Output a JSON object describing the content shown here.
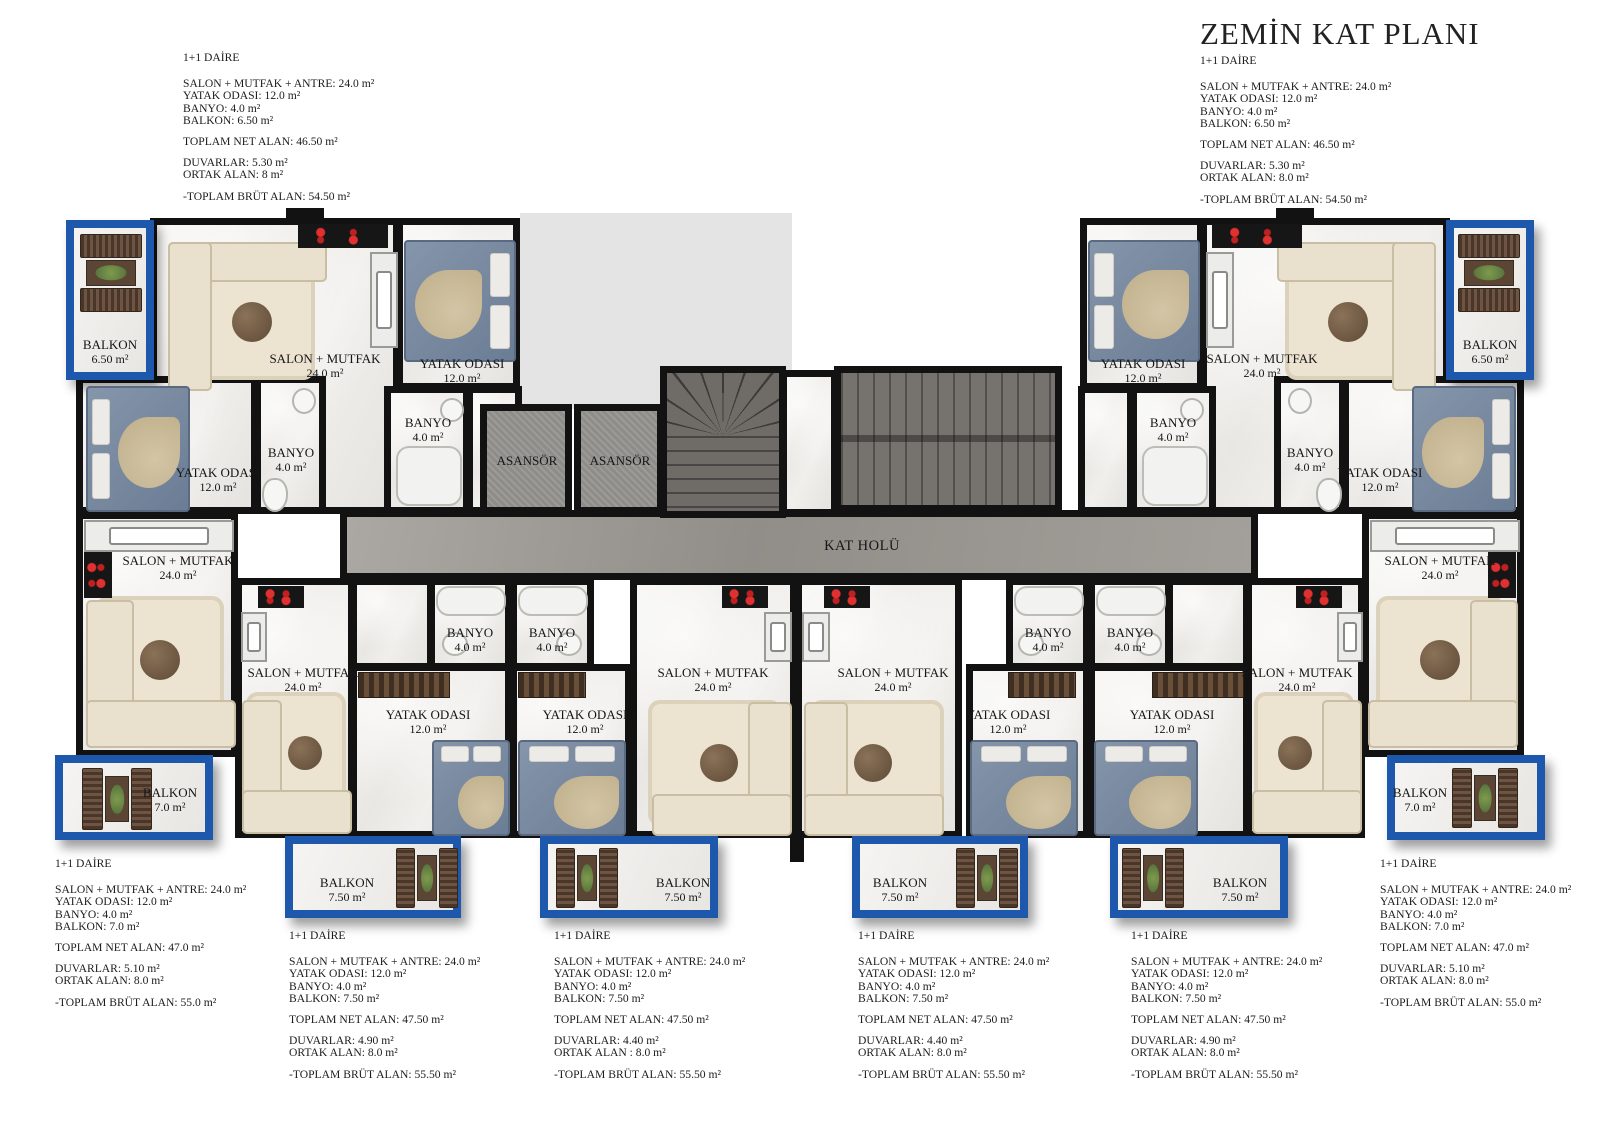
{
  "title": "ZEMİN KAT PLANI",
  "apartment_specs": [
    {
      "heading": "1+1 DAİRE",
      "salon": "SALON + MUTFAK + ANTRE: 24.0 m²",
      "bedroom": "YATAK ODASI: 12.0 m²",
      "bath": "BANYO: 4.0 m²",
      "balcony": "BALKON: 6.50 m²",
      "net": "TOPLAM NET ALAN: 46.50 m²",
      "walls": "DUVARLAR: 5.30 m²",
      "common": "ORTAK ALAN: 8 m²",
      "gross": "-TOPLAM BRÜT ALAN:  54.50 m²"
    },
    {
      "heading": "1+1 DAİRE",
      "salon": "SALON + MUTFAK + ANTRE: 24.0 m²",
      "bedroom": "YATAK ODASI: 12.0 m²",
      "bath": "BANYO: 4.0 m²",
      "balcony": "BALKON: 6.50 m²",
      "net": "TOPLAM NET ALAN: 46.50 m²",
      "walls": "DUVARLAR: 5.30 m²",
      "common": "ORTAK ALAN: 8.0 m²",
      "gross": "-TOPLAM BRÜT ALAN:  54.50 m²"
    },
    {
      "heading": "1+1 DAİRE",
      "salon": "SALON + MUTFAK + ANTRE: 24.0 m²",
      "bedroom": "YATAK ODASI: 12.0 m²",
      "bath": "BANYO: 4.0 m²",
      "balcony": "BALKON: 7.0 m²",
      "net": "TOPLAM NET ALAN: 47.0 m²",
      "walls": "DUVARLAR: 5.10 m²",
      "common": "ORTAK ALAN: 8.0 m²",
      "gross": "-TOPLAM BRÜT ALAN:  55.0 m²"
    },
    {
      "heading": "1+1 DAİRE",
      "salon": "SALON + MUTFAK + ANTRE: 24.0 m²",
      "bedroom": "YATAK ODASI: 12.0 m²",
      "bath": "BANYO: 4.0 m²",
      "balcony": "BALKON: 7.50 m²",
      "net": "TOPLAM NET ALAN: 47.50 m²",
      "walls": "DUVARLAR: 4.90 m²",
      "common": "ORTAK ALAN: 8.0 m²",
      "gross": "-TOPLAM BRÜT ALAN:  55.50 m²"
    },
    {
      "heading": "1+1 DAİRE",
      "salon": "SALON + MUTFAK + ANTRE: 24.0 m²",
      "bedroom": "YATAK ODASI: 12.0 m²",
      "bath": "BANYO: 4.0 m²",
      "balcony": "BALKON: 7.50 m²",
      "net": "TOPLAM NET ALAN: 47.50 m²",
      "walls": "DUVARLAR: 4.40 m²",
      "common": "ORTAK ALAN : 8.0 m²",
      "gross": "-TOPLAM BRÜT ALAN:  55.50 m²"
    },
    {
      "heading": "1+1 DAİRE",
      "salon": "SALON + MUTFAK + ANTRE: 24.0 m²",
      "bedroom": "YATAK ODASI: 12.0 m²",
      "bath": "BANYO: 4.0 m²",
      "balcony": "BALKON: 7.50 m²",
      "net": "TOPLAM NET ALAN: 47.50 m²",
      "walls": "DUVARLAR: 4.40 m²",
      "common": "ORTAK ALAN: 8.0 m²",
      "gross": "-TOPLAM BRÜT ALAN:  55.50 m²"
    },
    {
      "heading": "1+1 DAİRE",
      "salon": "SALON + MUTFAK + ANTRE: 24.0 m²",
      "bedroom": "YATAK ODASI: 12.0 m²",
      "bath": "BANYO: 4.0 m²",
      "balcony": "BALKON: 7.50 m²",
      "net": "TOPLAM NET ALAN: 47.50 m²",
      "walls": "DUVARLAR: 4.90 m²",
      "common": "ORTAK ALAN: 8.0 m²",
      "gross": "-TOPLAM BRÜT ALAN:  55.50 m²"
    },
    {
      "heading": "1+1 DAİRE",
      "salon": "SALON + MUTFAK + ANTRE: 24.0 m²",
      "bedroom": "YATAK ODASI: 12.0 m²",
      "bath": "BANYO: 4.0 m²",
      "balcony": "BALKON: 7.0 m²",
      "net": "TOPLAM NET ALAN: 47.0 m²",
      "walls": "DUVARLAR: 5.10 m²",
      "common": "ORTAK ALAN: 8.0 m²",
      "gross": "-TOPLAM BRÜT ALAN:  55.0 m²"
    }
  ],
  "plan": {
    "labels": {
      "salon_name": "SALON + MUTFAK",
      "salon_area": "24.0 m²",
      "bedroom_name": "YATAK ODASI",
      "bedroom_area": "12.0 m²",
      "bath_name": "BANYO",
      "bath_area": "4.0 m²",
      "balcony_name": "BALKON",
      "balcony_area_650": "6.50 m²",
      "balcony_area_70": "7.0 m²",
      "balcony_area_750": "7.50 m²",
      "elevator": "ASANSÖR",
      "hall": "KAT HOLÜ"
    },
    "colors": {
      "balcony_frame": "#1d58ac",
      "wall": "#121212",
      "corridor": "#9b9792",
      "stairs": "#6f6c68",
      "void": "#e4e4e4",
      "burner_red": "#d42020"
    }
  }
}
